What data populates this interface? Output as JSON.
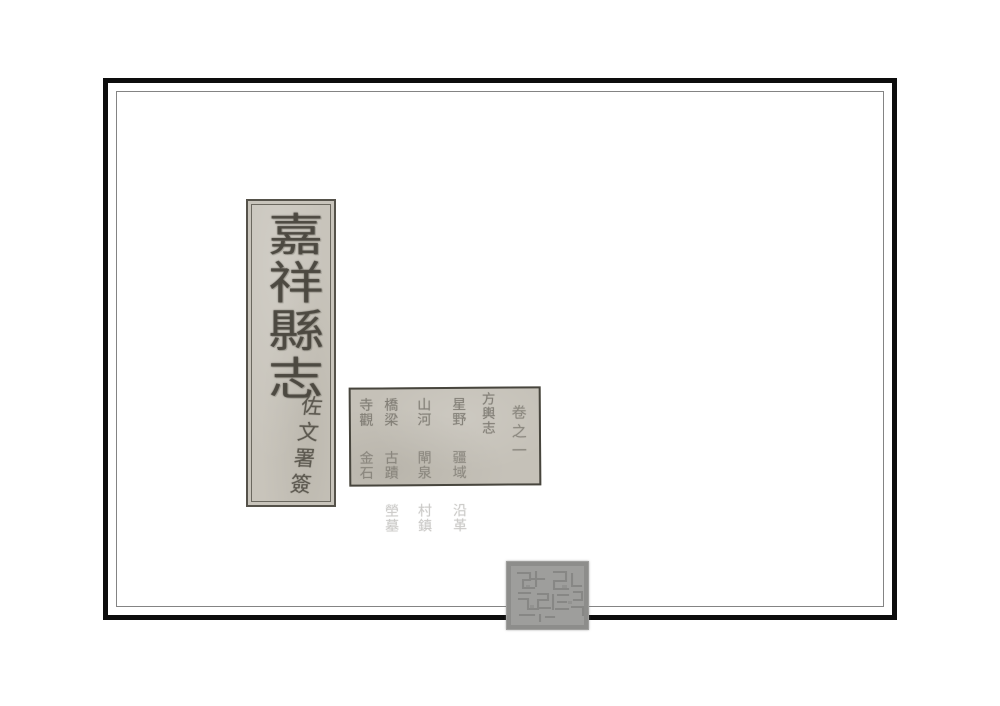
{
  "title_slip": {
    "title": "嘉祥縣志",
    "signature": "佐文署簽"
  },
  "contents_slip": {
    "volume": "卷之一",
    "section": "方輿志",
    "columns": [
      {
        "items": [
          "星野",
          "疆域",
          "沿革"
        ]
      },
      {
        "items": [
          "山河",
          "閘泉",
          "村鎮"
        ]
      },
      {
        "items": [
          "橋梁",
          "古蹟",
          "塋墓"
        ]
      },
      {
        "items": [
          "寺觀",
          "金石"
        ]
      }
    ]
  },
  "colors": {
    "page_background": "#ffffff",
    "frame_border": "#0d0d0d",
    "slip_paper": "#c8c4bb",
    "ink": "#4e4b43",
    "seal_grey": "#9e9e9c",
    "seal_pattern": "#7f7f7d"
  }
}
